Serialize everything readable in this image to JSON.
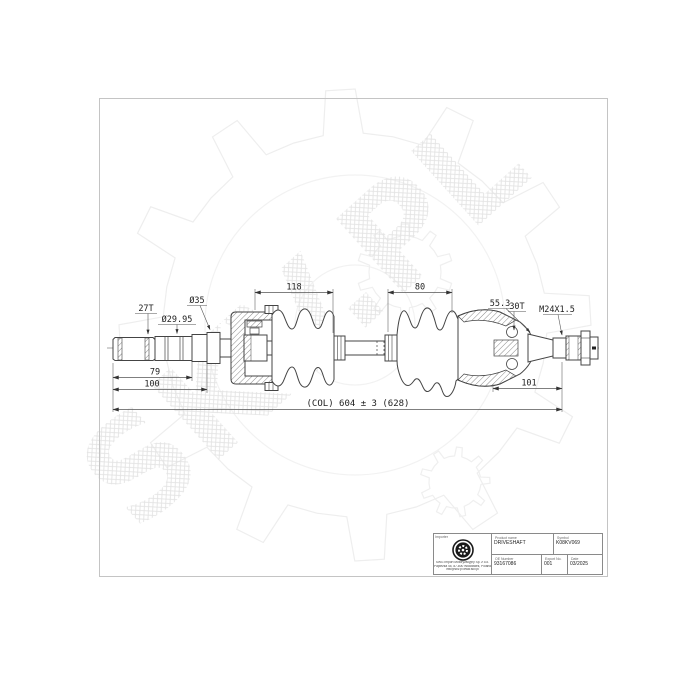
{
  "watermark": {
    "text": "SKV.PL"
  },
  "drawing": {
    "labels": {
      "spline_count_left": "27T",
      "shaft_diameter": "Ø29.95",
      "collar_diameter": "Ø35",
      "inner_boot_span": "118",
      "outer_boot_span": "80",
      "joint_length": "55.3",
      "spline_count_right": "30T",
      "thread_spec": "M24X1.5",
      "dim_79": "79",
      "dim_100": "100",
      "dim_101": "101",
      "overall_length": "(COL) 604 ± 3 (628)"
    }
  },
  "title_block": {
    "importer_label": "Importer",
    "company_address_line1": "SWG Import Motoryzacyjny Sp. z o.o.",
    "company_address_line2": "Papieżka 45, 87-800 Włocławek, Poland",
    "company_address_line3": "info@skv.pl  www.skv.pl",
    "product_name_label": "Product name",
    "product_name_value": "DRIVESHAFT",
    "symbol_label": "Symbol",
    "symbol_value": "K08KV069",
    "oe_number_label": "OE Number",
    "oe_number_value": "93167086",
    "export_no_label": "Export No.",
    "export_no_value": "001",
    "date_label": "Date",
    "date_value": "03/2025"
  }
}
